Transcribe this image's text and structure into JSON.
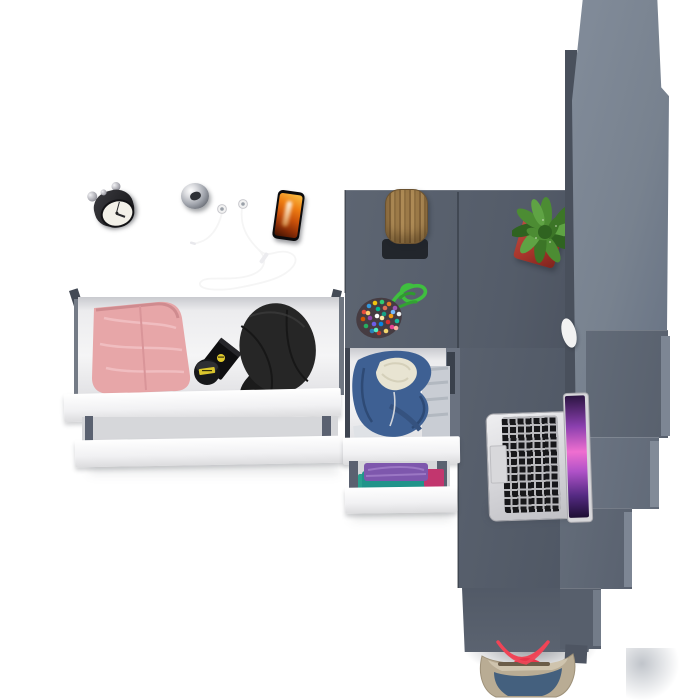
{
  "scene": {
    "title": "Top-down 3D render of a room corner with desk, drawers and stairs",
    "background_color": "#ffffff",
    "objects": [
      {
        "id": "desk",
        "label": "dark gray desk with angled legs",
        "color": "#5d6573"
      },
      {
        "id": "alarm-clock",
        "label": "black alarm clock on desk",
        "color": "#1d1d20"
      },
      {
        "id": "chrome-knob",
        "label": "chrome knob on desk",
        "color": "#9fa3ab"
      },
      {
        "id": "earphones",
        "label": "white wired earphones on desk",
        "color": "#f5f5f5"
      },
      {
        "id": "smartphone",
        "label": "smartphone with orange flame wallpaper",
        "color": "#ee7d12"
      },
      {
        "id": "open-drawer",
        "label": "open drawer with pink trousers, black watch box and black cap",
        "colors": [
          "#e7a6a8",
          "#0f0f11",
          "#232323"
        ]
      },
      {
        "id": "drawer-fronts",
        "label": "white drawer fronts",
        "color": "#f7f7f8"
      },
      {
        "id": "hoodie-drawer",
        "label": "drawer with blue hoodie and folded shirts",
        "colors": [
          "#3e6093",
          "#e8e4d2"
        ]
      },
      {
        "id": "clothes-drawer",
        "label": "drawer with purple, teal and magenta shirts",
        "colors": [
          "#7e57ad",
          "#21948a",
          "#c2366e"
        ]
      },
      {
        "id": "log-stool",
        "label": "wooden log stool on black base",
        "colors": [
          "#9c7a48",
          "#22262c"
        ]
      },
      {
        "id": "beaded-pouch",
        "label": "multicolor beaded pouch with green cord",
        "color": "#3fbf3f"
      },
      {
        "id": "cactus",
        "label": "green cactus in red pot",
        "colors": [
          "#4c8c33",
          "#a8362c"
        ]
      },
      {
        "id": "wardrobe",
        "label": "tall gray wardrobe seen from above",
        "color": "#78828f"
      },
      {
        "id": "stairs",
        "label": "stepped gray stairs",
        "color": "#646d7b"
      },
      {
        "id": "laptop",
        "label": "silver laptop with purple wallpaper",
        "colors": [
          "#d9d9dc",
          "#ef6fd0"
        ]
      },
      {
        "id": "white-object",
        "label": "small white object near stairs",
        "color": "#f2f2f2"
      },
      {
        "id": "tote-bag",
        "label": "beige and blue tote bag with red straps",
        "colors": [
          "#b9ac94",
          "#44607e",
          "#ef4556"
        ]
      }
    ]
  },
  "palette": {
    "bg": "#ffffff",
    "furniture_dark": "#5d6573",
    "wardrobe_face": "#78828f",
    "stool_base": "#22262c",
    "pot_red": "#a8362c",
    "screen_magenta": "#ef6fd0",
    "phone_screen_orange": "#ee7d12",
    "pants_pink": "#e7a6a8",
    "hoodie_blue": "#3e6093",
    "hoodie_lining": "#e8e4d2",
    "shirt_purple": "#7e57ad",
    "shirt_teal": "#21948a",
    "shirt_magenta": "#c2366e",
    "cord_green": "#3fbf3f",
    "cactus_green": "#4c8c33",
    "bag_beige": "#b9ac94",
    "bag_blue": "#44607e",
    "strap_red": "#ef4556",
    "cable_white": "#f5f5f5"
  }
}
